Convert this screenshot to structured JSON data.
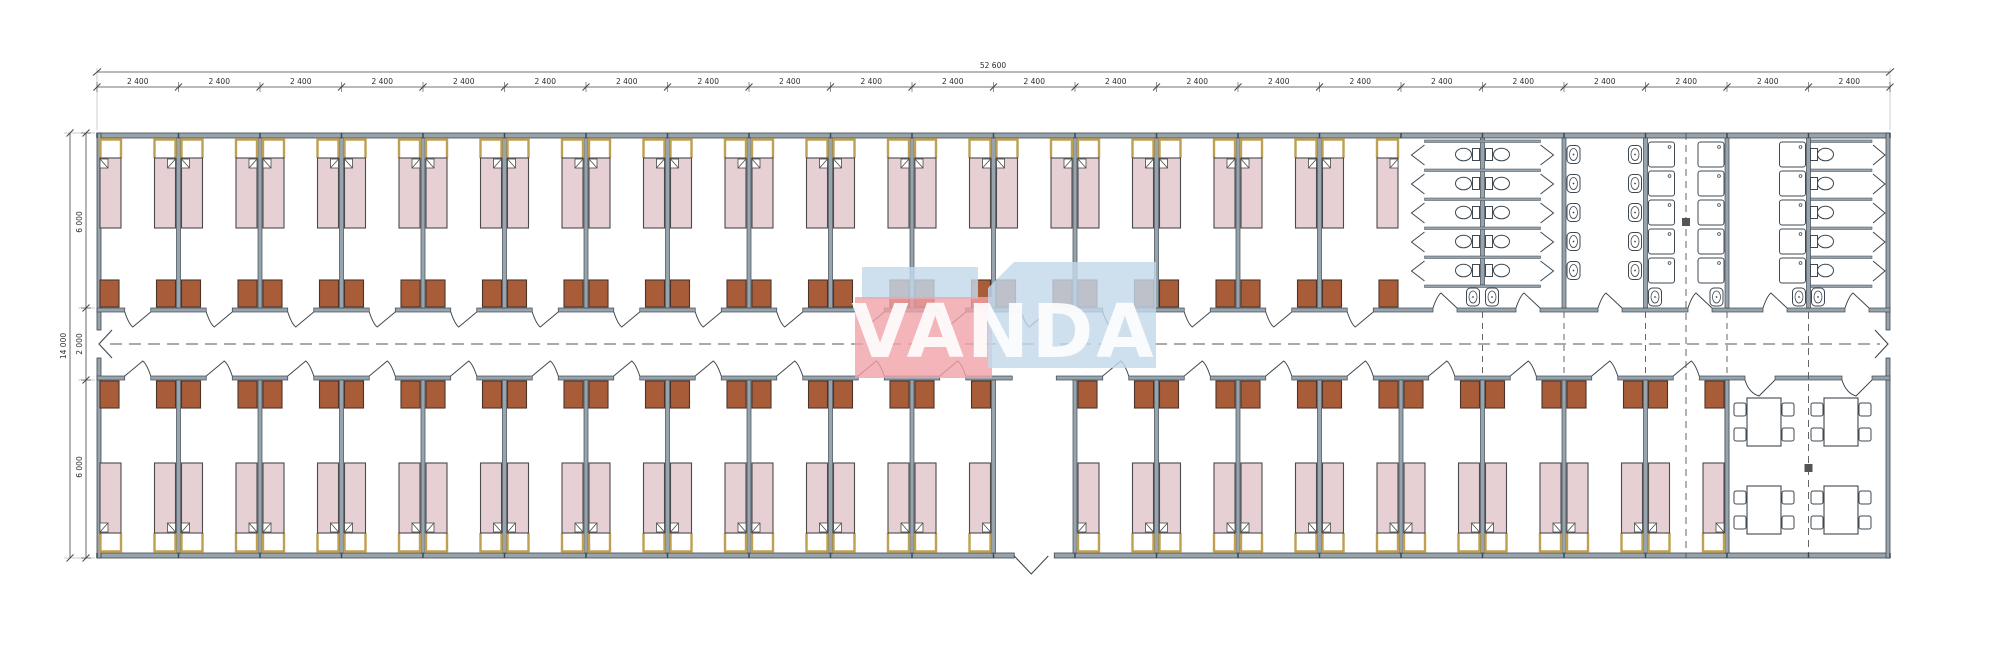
{
  "drawing_kind": "modular dormitory floor plan",
  "dimensions": {
    "total_width": "52 600",
    "module_width": "2 400",
    "module_count": 22,
    "total_height": "14 000",
    "room_depth_top": "6 000",
    "corridor_width": "2 000",
    "room_depth_bottom": "6 000"
  },
  "watermark": {
    "text": "VANDA",
    "red_block_color": "#f0a2a8",
    "blue_block_color": "#c3d8ea"
  },
  "colors": {
    "wall_fill": "#98a4ad",
    "wall_edge": "#3f4850",
    "bed_fill": "#e6d0d3",
    "bed_stroke": "#4a4a4a",
    "pillow_stroke": "#bfa052",
    "wardrobe_fill": "#a85c38",
    "wardrobe_stroke": "#4c332a",
    "line": "#3f4850",
    "dim_line": "#444444",
    "axis_dash": "#555555",
    "fixture_fill": "#ffffff",
    "background": "#ffffff"
  },
  "layout": {
    "top_bedroom_modules": 16,
    "bottom_bedroom_modules": 20,
    "entrance_module_index": 11,
    "beds_per_module": 2,
    "wardrobes_per_module": 2,
    "sanitary": {
      "toilet_stall_rows": 5,
      "toilet_count": 15,
      "washbasin_count": 16,
      "shower_count": 15
    },
    "dining": {
      "table_count": 4,
      "chairs_per_table": 4
    }
  }
}
